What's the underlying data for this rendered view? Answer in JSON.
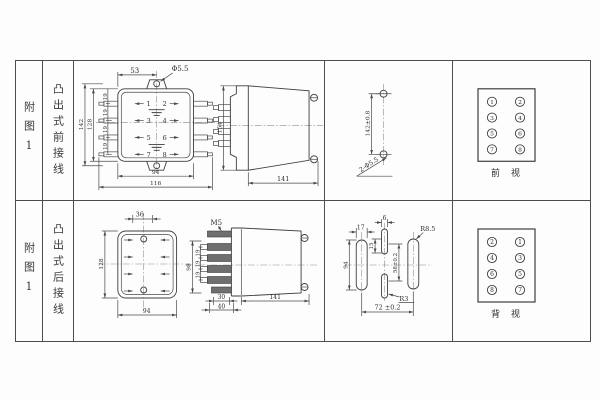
{
  "rows": [
    {
      "fig": "附图1",
      "wiring": "凸出式前接线",
      "front": {
        "dim_53": "53",
        "hole_label": "Φ5.5",
        "dim_142": "142",
        "dim_128": "128",
        "pitch": [
          "19",
          "19",
          "19",
          "19"
        ],
        "dim_94": "94",
        "dim_116": "116",
        "terminals": [
          "1",
          "2",
          "3",
          "4",
          "5",
          "6",
          "7",
          "8"
        ]
      },
      "side": {
        "dim_154": "154",
        "dim_141": "141"
      },
      "drill": {
        "dim_spacing": "142±0.8",
        "holes_label": "2-Φ5.5"
      },
      "panel": {
        "terminals": [
          "1",
          "2",
          "3",
          "4",
          "5",
          "6",
          "7",
          "8"
        ],
        "caption": "前　视"
      }
    },
    {
      "fig": "附图1",
      "wiring": "凸出式后接线",
      "rear": {
        "dim_36": "36",
        "dim_128": "128",
        "dim_94": "94"
      },
      "side": {
        "thread": "M5",
        "dim_98": "98",
        "pitch": [
          "19",
          "19",
          "19"
        ],
        "dim_30": "30",
        "dim_40": "40",
        "dim_141": "141"
      },
      "cutout": {
        "dim_17": "17",
        "dim_94": "94",
        "dim_6": "6",
        "dim_15": "15",
        "dim_span_v": "58±0.2",
        "r_big": "R8.5",
        "r_small": "R3",
        "dim_span_h": "72 ±0.2"
      },
      "panel": {
        "terminals": [
          "2",
          "1",
          "4",
          "3",
          "6",
          "5",
          "8",
          "7"
        ],
        "caption": "背　视"
      }
    }
  ]
}
